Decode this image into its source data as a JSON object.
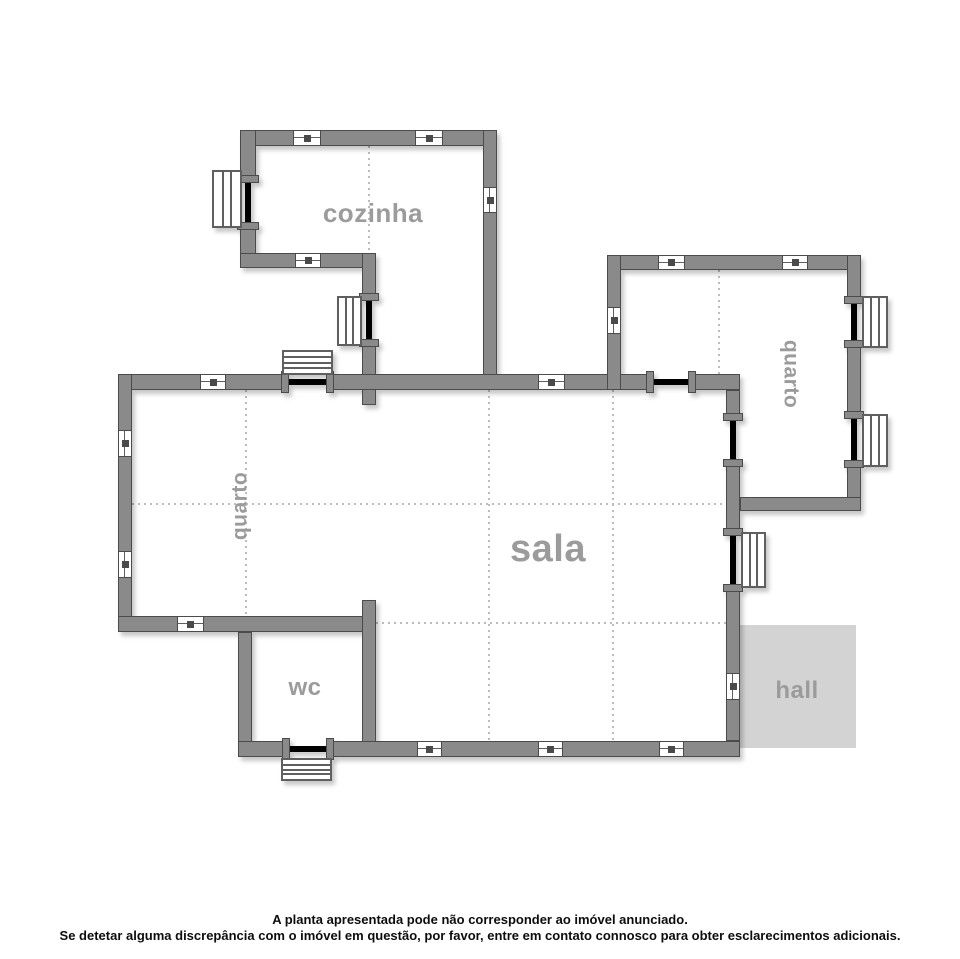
{
  "title": "floor-plan",
  "colors": {
    "background": "#ffffff",
    "wall": "#8a8a8a",
    "wall_outline": "#4b4b4b",
    "opening": "#000000",
    "symbol_border": "#5f5f5f",
    "dotted": "#bcbcbc",
    "label": "#9b9b9b",
    "hall_fill": "#d3d3d3",
    "footer_text": "#0d0d0d"
  },
  "rooms": [
    {
      "id": "cozinha",
      "label": "cozinha",
      "x": 373,
      "y": 213,
      "size": 26,
      "rotate": 0
    },
    {
      "id": "quarto-left",
      "label": "quarto",
      "x": 240,
      "y": 506,
      "size": 21,
      "rotate": -90
    },
    {
      "id": "quarto-right",
      "label": "quarto",
      "x": 791,
      "y": 374,
      "size": 21,
      "rotate": 90
    },
    {
      "id": "sala",
      "label": "sala",
      "x": 548,
      "y": 549,
      "size": 38,
      "rotate": 0
    },
    {
      "id": "wc",
      "label": "wc",
      "x": 305,
      "y": 688,
      "size": 24,
      "rotate": 0
    },
    {
      "id": "hall",
      "label": "hall",
      "x": 797,
      "y": 691,
      "size": 24,
      "rotate": 0
    }
  ],
  "plan": {
    "hall_area": {
      "x": 740,
      "y": 625,
      "w": 116,
      "h": 123
    },
    "walls": [
      [
        240,
        130,
        257,
        16
      ],
      [
        240,
        130,
        16,
        52
      ],
      [
        240,
        222,
        16,
        46
      ],
      [
        240,
        253,
        134,
        15
      ],
      [
        362,
        253,
        14,
        47
      ],
      [
        362,
        340,
        14,
        65
      ],
      [
        483,
        130,
        14,
        260
      ],
      [
        118,
        374,
        170,
        16
      ],
      [
        327,
        374,
        326,
        16
      ],
      [
        689,
        374,
        51,
        16
      ],
      [
        118,
        374,
        14,
        258
      ],
      [
        118,
        616,
        256,
        16
      ],
      [
        238,
        632,
        14,
        125
      ],
      [
        362,
        600,
        14,
        157
      ],
      [
        238,
        741,
        51,
        16
      ],
      [
        327,
        741,
        413,
        16
      ],
      [
        607,
        255,
        254,
        15
      ],
      [
        607,
        255,
        14,
        135
      ],
      [
        847,
        255,
        14,
        48
      ],
      [
        847,
        341,
        14,
        77
      ],
      [
        847,
        461,
        14,
        50
      ],
      [
        740,
        497,
        121,
        14
      ],
      [
        726,
        390,
        14,
        30
      ],
      [
        726,
        460,
        14,
        75
      ],
      [
        726,
        585,
        14,
        156
      ]
    ],
    "openings": [
      {
        "kind": "window",
        "o": "v",
        "wx": 240,
        "t": 16,
        "pos": 183,
        "len": 39
      },
      {
        "kind": "window",
        "o": "v",
        "wx": 362,
        "t": 14,
        "pos": 301,
        "len": 38
      },
      {
        "kind": "window",
        "o": "v",
        "wx": 847,
        "t": 14,
        "pos": 304,
        "len": 36
      },
      {
        "kind": "window",
        "o": "v",
        "wx": 847,
        "t": 14,
        "pos": 419,
        "len": 41
      },
      {
        "kind": "window",
        "o": "v",
        "wx": 726,
        "t": 14,
        "pos": 536,
        "len": 48
      },
      {
        "kind": "door",
        "o": "h",
        "wy": 374,
        "t": 16,
        "pos": 289,
        "len": 37
      },
      {
        "kind": "door",
        "o": "h",
        "wy": 374,
        "t": 16,
        "pos": 654,
        "len": 34
      },
      {
        "kind": "door",
        "o": "h",
        "wy": 741,
        "t": 16,
        "pos": 290,
        "len": 36
      },
      {
        "kind": "door",
        "o": "v",
        "wx": 726,
        "t": 14,
        "pos": 421,
        "len": 38
      }
    ],
    "window_symbols": [
      {
        "x": 212,
        "y": 170,
        "w": 30,
        "h": 58,
        "lines": 2,
        "dir": "v",
        "name": "window-symbol-cozinha-left"
      },
      {
        "x": 337,
        "y": 296,
        "w": 25,
        "h": 50,
        "lines": 2,
        "dir": "v",
        "name": "window-symbol-cozinha-inner"
      },
      {
        "x": 862,
        "y": 296,
        "w": 26,
        "h": 52,
        "lines": 2,
        "dir": "v",
        "name": "window-symbol-quarto-right-1"
      },
      {
        "x": 862,
        "y": 414,
        "w": 26,
        "h": 53,
        "lines": 2,
        "dir": "v",
        "name": "window-symbol-quarto-right-2"
      },
      {
        "x": 741,
        "y": 532,
        "w": 25,
        "h": 56,
        "lines": 2,
        "dir": "v",
        "name": "window-symbol-east-wall"
      },
      {
        "x": 282,
        "y": 350,
        "w": 51,
        "h": 25,
        "lines": 3,
        "dir": "h",
        "name": "steps-symbol-north-door"
      },
      {
        "x": 281,
        "y": 758,
        "w": 51,
        "h": 23,
        "lines": 3,
        "dir": "h",
        "name": "steps-symbol-wc-door"
      }
    ],
    "vents": [
      {
        "o": "h",
        "x": 293,
        "y": 130,
        "len": 28,
        "t": 16
      },
      {
        "o": "h",
        "x": 415,
        "y": 130,
        "len": 28,
        "t": 16
      },
      {
        "o": "h",
        "x": 295,
        "y": 253,
        "len": 26,
        "t": 15
      },
      {
        "o": "v",
        "x": 483,
        "y": 187,
        "len": 26,
        "t": 14
      },
      {
        "o": "h",
        "x": 200,
        "y": 374,
        "len": 26,
        "t": 16
      },
      {
        "o": "h",
        "x": 538,
        "y": 374,
        "len": 27,
        "t": 16
      },
      {
        "o": "v",
        "x": 118,
        "y": 430,
        "len": 27,
        "t": 14
      },
      {
        "o": "v",
        "x": 118,
        "y": 551,
        "len": 27,
        "t": 14
      },
      {
        "o": "h",
        "x": 177,
        "y": 616,
        "len": 27,
        "t": 16
      },
      {
        "o": "h",
        "x": 417,
        "y": 741,
        "len": 25,
        "t": 16
      },
      {
        "o": "h",
        "x": 538,
        "y": 741,
        "len": 25,
        "t": 16
      },
      {
        "o": "h",
        "x": 659,
        "y": 741,
        "len": 25,
        "t": 16
      },
      {
        "o": "h",
        "x": 658,
        "y": 255,
        "len": 27,
        "t": 15
      },
      {
        "o": "h",
        "x": 782,
        "y": 255,
        "len": 26,
        "t": 15
      },
      {
        "o": "v",
        "x": 607,
        "y": 307,
        "len": 27,
        "t": 14
      },
      {
        "o": "v",
        "x": 726,
        "y": 673,
        "len": 27,
        "t": 14
      }
    ],
    "dotted_lines": [
      {
        "o": "v",
        "x": 368,
        "a": 146,
        "b": 374
      },
      {
        "o": "v",
        "x": 245,
        "a": 390,
        "b": 616
      },
      {
        "o": "v",
        "x": 488,
        "a": 390,
        "b": 741
      },
      {
        "o": "v",
        "x": 612,
        "a": 390,
        "b": 741
      },
      {
        "o": "v",
        "x": 718,
        "a": 270,
        "b": 374
      },
      {
        "o": "h",
        "y": 503,
        "a": 132,
        "b": 726
      },
      {
        "o": "h",
        "y": 622,
        "a": 376,
        "b": 726
      }
    ]
  },
  "footer": {
    "line1": "A planta apresentada pode não corresponder ao imóvel anunciado.",
    "line2": "Se detetar alguma discrepância com o imóvel em questão, por favor, entre em contato connosco para obter esclarecimentos adicionais."
  }
}
